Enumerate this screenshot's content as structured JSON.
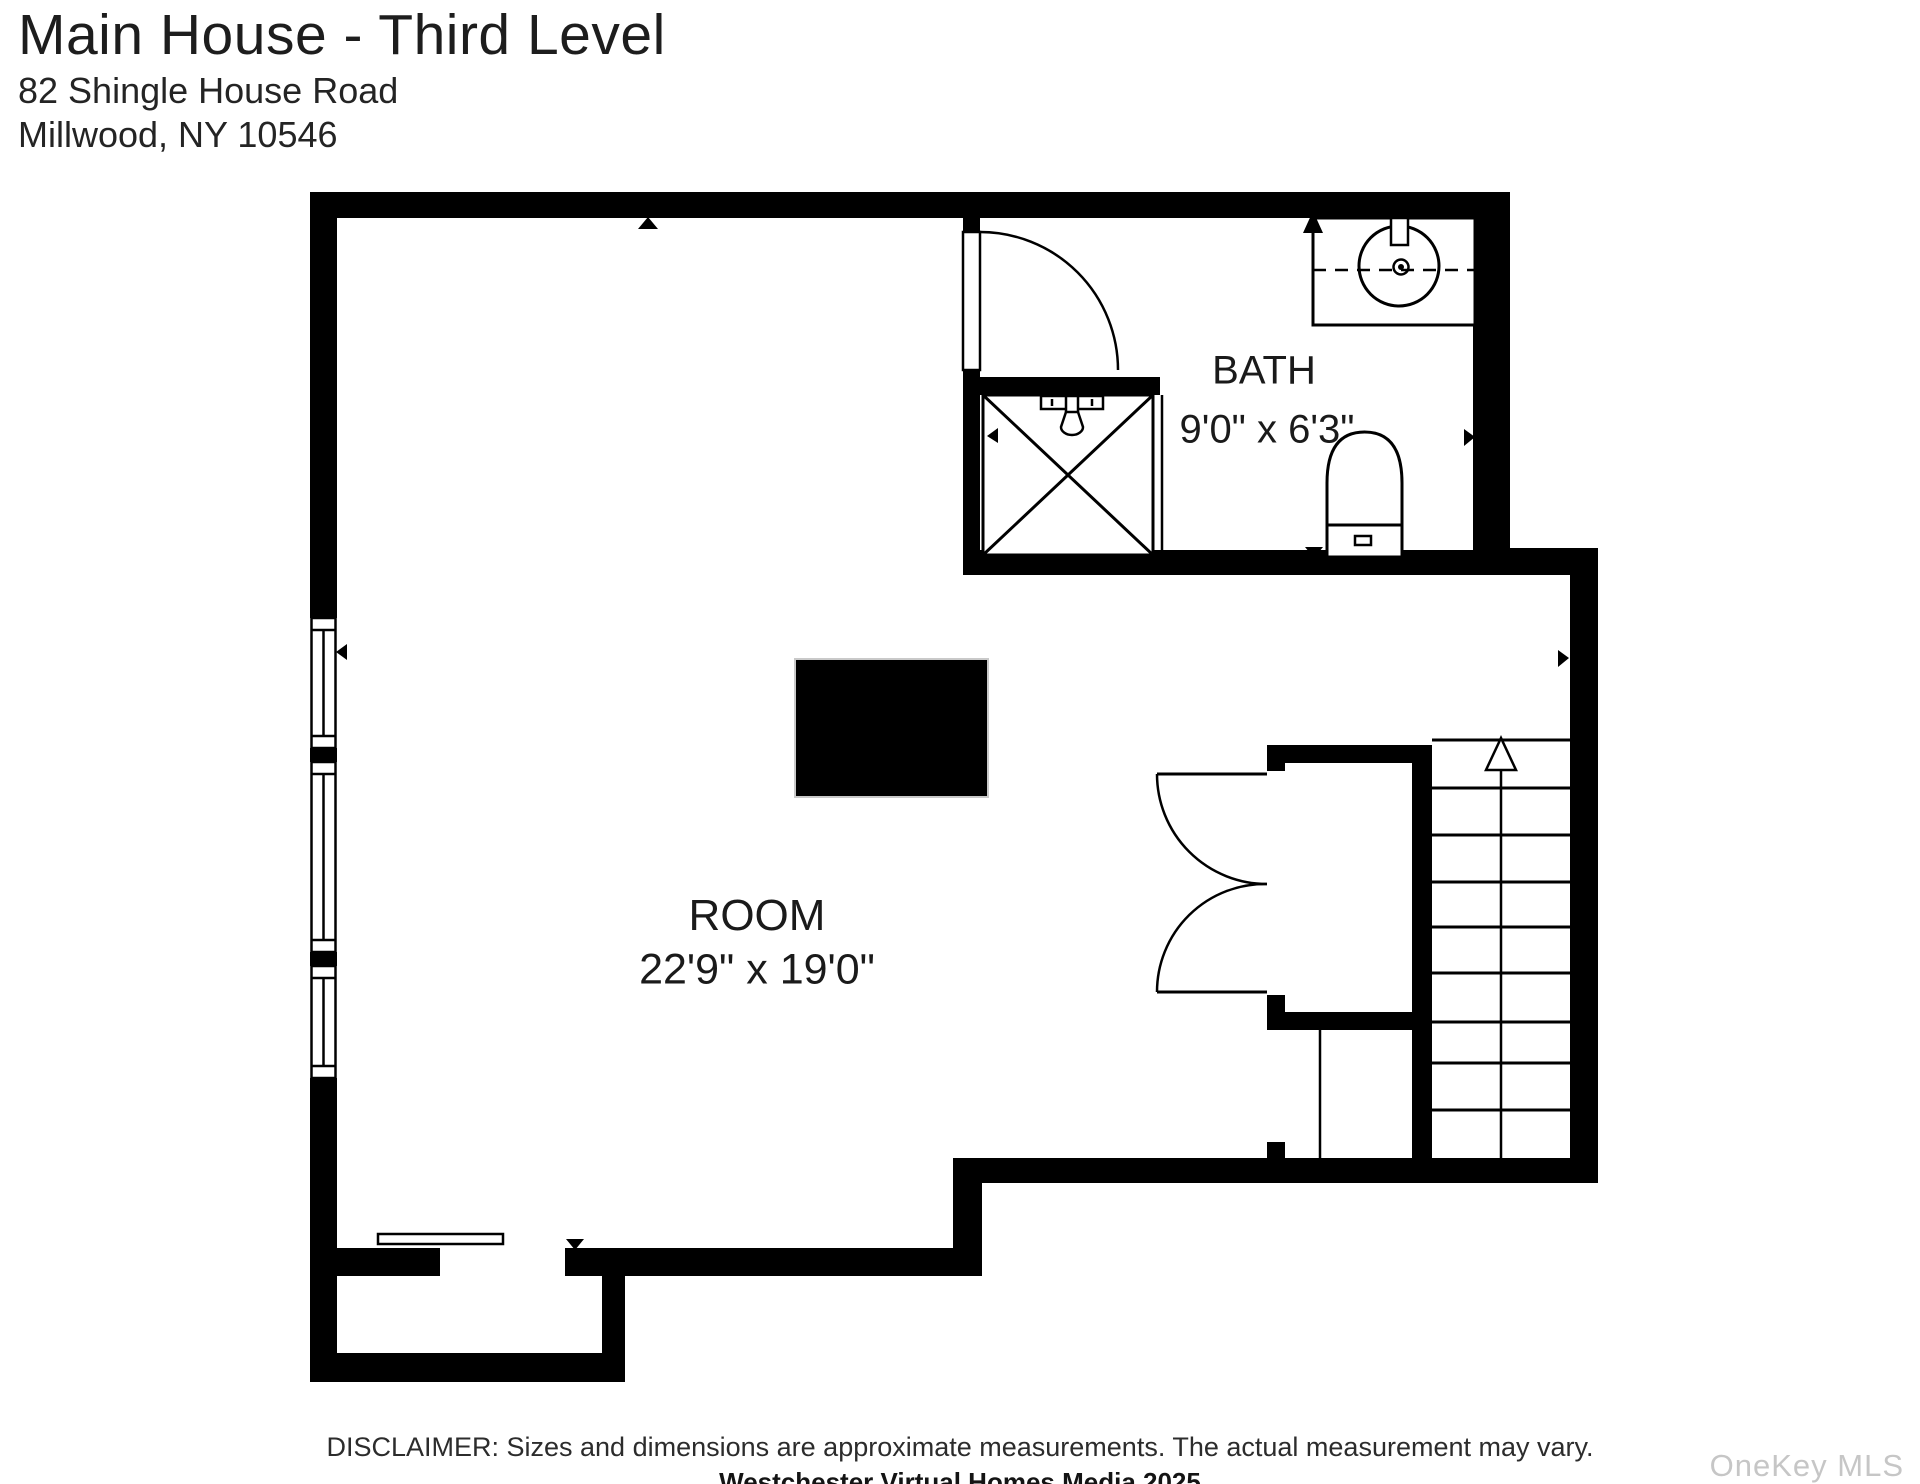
{
  "header": {
    "title": "Main House - Third Level",
    "address_line1": "82 Shingle House Road",
    "address_line2": "Millwood, NY 10546"
  },
  "plan": {
    "rooms": [
      {
        "name": "ROOM",
        "dimensions": "22'9\" x 19'0\""
      },
      {
        "name": "BATH",
        "dimensions": "9'0\" x 6'3\""
      }
    ],
    "stairs_direction": "up",
    "wall_color": "#000000",
    "background": "#ffffff"
  },
  "footer": {
    "disclaimer": "DISCLAIMER: Sizes and dimensions are approximate measurements. The actual measurement may vary.",
    "credit": "Westchester Virtual Homes Media 2025",
    "watermark": "OneKey MLS",
    "watermark_color": "#c6c6c6"
  }
}
